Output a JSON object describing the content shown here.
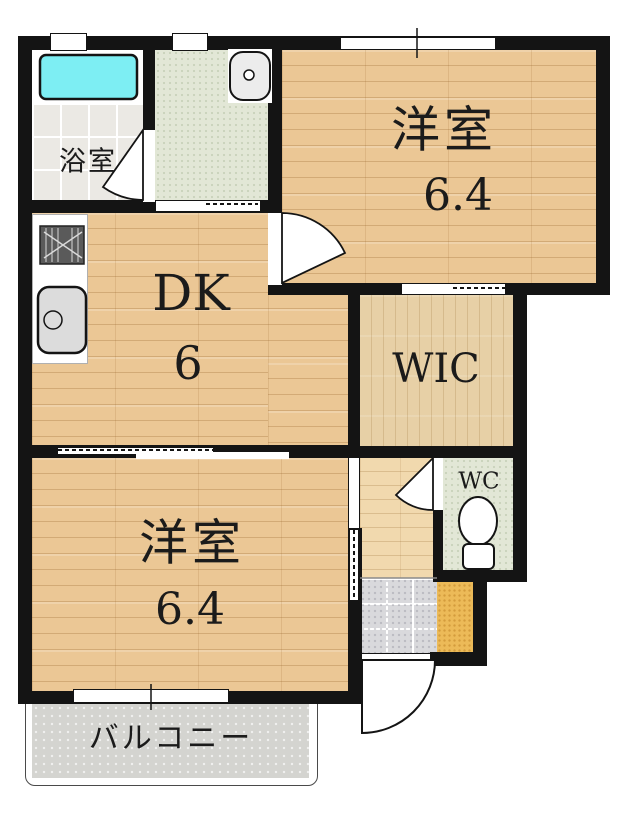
{
  "floorplan": {
    "rooms": {
      "bathroom": {
        "label": "浴室"
      },
      "bedroom_top": {
        "label": "洋室",
        "size": "6.4"
      },
      "dining_kitchen": {
        "label": "DK",
        "size": "6"
      },
      "wic": {
        "label": "WIC"
      },
      "wc": {
        "label": "WC"
      },
      "bedroom_bottom": {
        "label": "洋室",
        "size": "6.4"
      },
      "balcony": {
        "label": "バルコニー"
      }
    },
    "colors": {
      "wall": "#141414",
      "wood_floor": "#ebc795",
      "wic_floor": "#e7d0a6",
      "hall_floor": "#f1d9ae",
      "bathtub": "#7deef3",
      "washroom_floor": "#e2e7d6",
      "wc_floor": "#e2e7d6",
      "genkan_tile": "#d9d9dc",
      "genkan_step": "#ecba58",
      "balcony": "#d4d4d0"
    },
    "fixtures": [
      "bathtub-icon",
      "washbasin-icon",
      "stove-icon",
      "kitchen-sink-icon",
      "toilet-icon"
    ]
  }
}
